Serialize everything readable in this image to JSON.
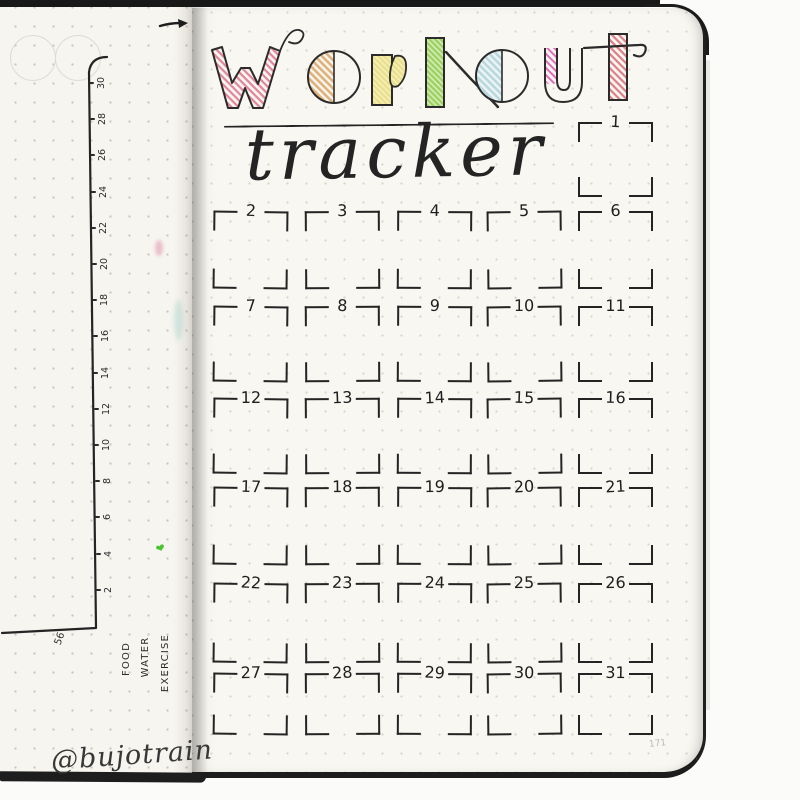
{
  "notebook": {
    "watermark": "@bujotrain",
    "left_page": {
      "page_number": "56",
      "axis_ticks": [
        "30",
        "28",
        "26",
        "24",
        "22",
        "20",
        "18",
        "16",
        "14",
        "12",
        "10",
        "8",
        "6",
        "4",
        "2"
      ],
      "categories": [
        "FOOD",
        "WATER",
        "EXERCISE"
      ],
      "icons": {
        "green_heart": "❤"
      }
    },
    "right_page": {
      "page_number": "171",
      "title": "workout",
      "subtitle": "tracker",
      "title_letters": [
        {
          "char": "w",
          "color": "#e2849a"
        },
        {
          "char": "o",
          "color": "#dfb07a"
        },
        {
          "char": "r",
          "color": "#e9df8e"
        },
        {
          "char": "k",
          "color": "#9ed262"
        },
        {
          "char": "o",
          "color": "#b7d8de"
        },
        {
          "char": "u",
          "color": "#df6cbb"
        },
        {
          "char": "t",
          "color": "#dd7f84"
        }
      ],
      "days": [
        "1",
        "2",
        "3",
        "4",
        "5",
        "6",
        "7",
        "8",
        "9",
        "10",
        "11",
        "12",
        "13",
        "14",
        "15",
        "16",
        "17",
        "18",
        "19",
        "20",
        "21",
        "22",
        "23",
        "24",
        "25",
        "26",
        "27",
        "28",
        "29",
        "30",
        "31"
      ]
    }
  },
  "colors": {
    "ink": "#262626",
    "paper": "#f7f6f1"
  }
}
